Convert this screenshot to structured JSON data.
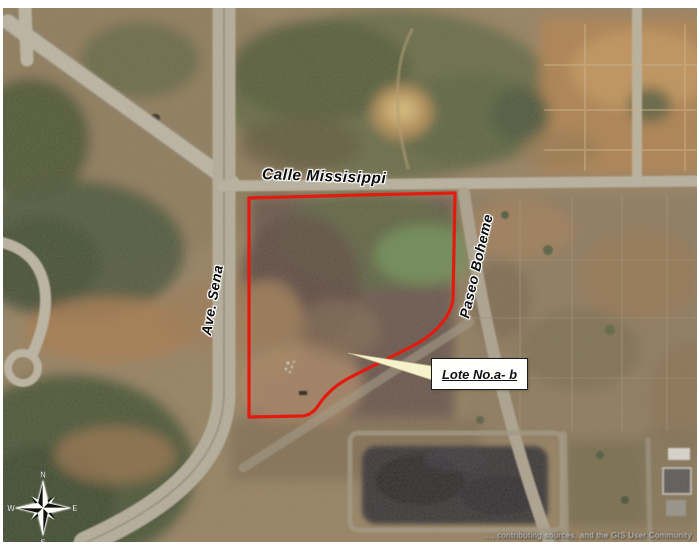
{
  "map": {
    "road_labels": {
      "calle": "Calle Missisippi",
      "ave": "Ave. Sena",
      "paseo": "Paseo Boheme"
    },
    "parcel_callout": "Lote No.a- b",
    "compass": {
      "n": "N",
      "e": "E",
      "s": "S",
      "w": "W"
    },
    "attribution": "…, contributing sources, and the GIS User Community",
    "colors": {
      "parcel_outline": "#e41a0f",
      "callout_fill": "#f6f2cb",
      "callout_box_bg": "#fffffe",
      "callout_box_border": "#1a1a1a",
      "label_text": "#0d0d0d",
      "frame": "#ffffff"
    }
  }
}
